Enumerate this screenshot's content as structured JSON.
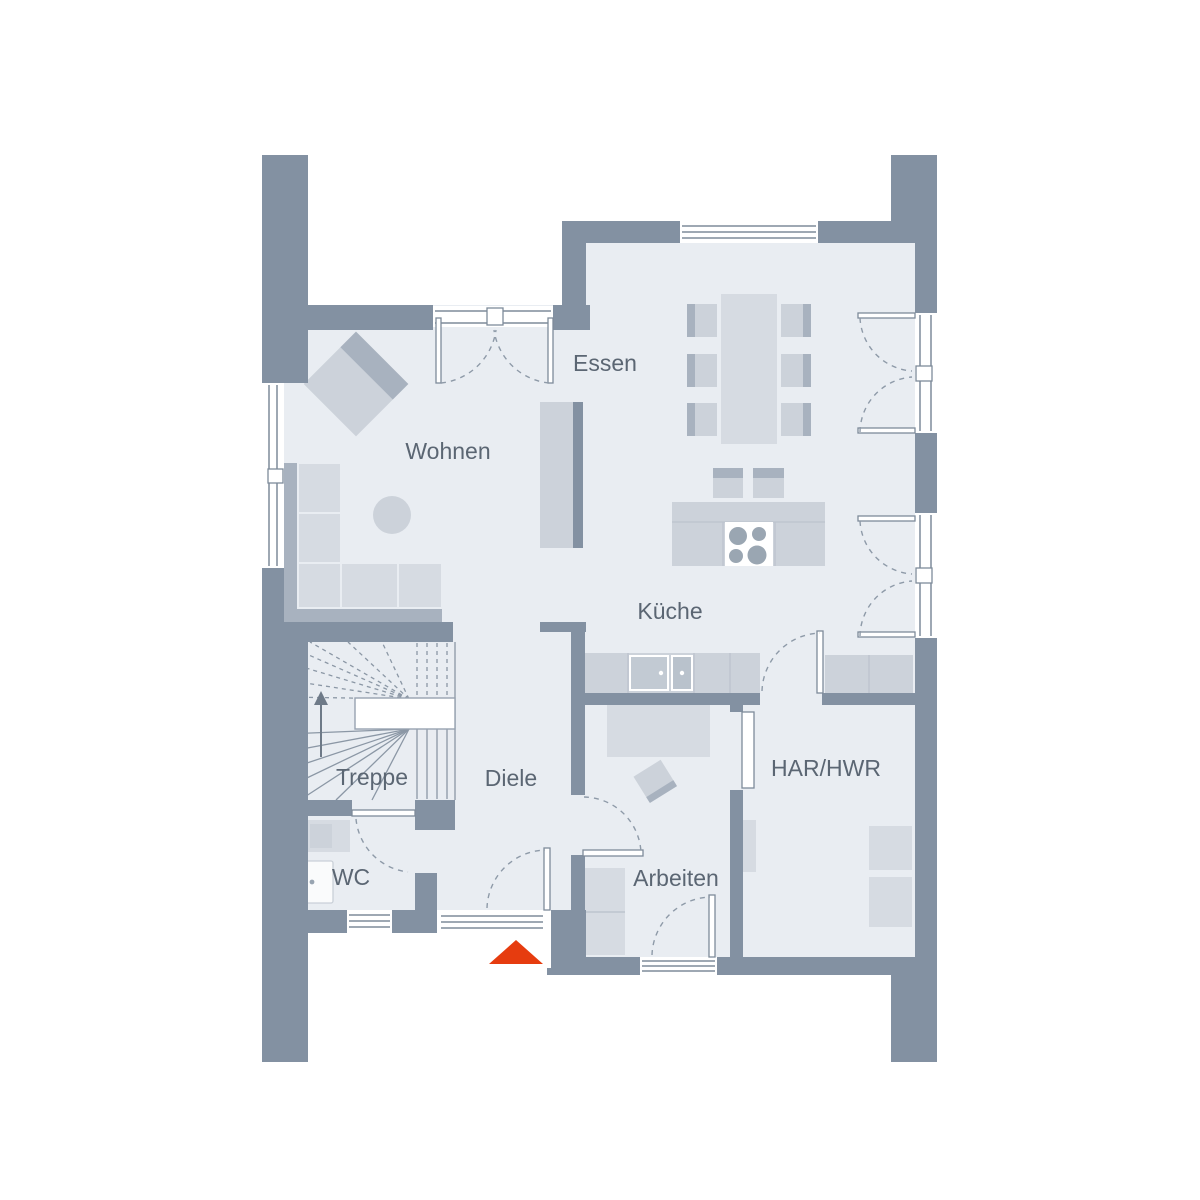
{
  "plan": {
    "rooms": [
      {
        "id": "wohnen",
        "label": "Wohnen"
      },
      {
        "id": "essen",
        "label": "Essen"
      },
      {
        "id": "kueche",
        "label": "Küche"
      },
      {
        "id": "treppe",
        "label": "Treppe"
      },
      {
        "id": "diele",
        "label": "Diele"
      },
      {
        "id": "wc",
        "label": "WC"
      },
      {
        "id": "arbeiten",
        "label": "Arbeiten"
      },
      {
        "id": "har_hwr",
        "label": "HAR/HWR"
      }
    ],
    "colors": {
      "wall": "#8391a2",
      "floor": "#e9edf2",
      "furniture_light": "#d6dbe2",
      "furniture_mid": "#ccd2da",
      "furniture_dark": "#a8b2bf",
      "line": "#8e9aa8",
      "text": "#5b6673",
      "entrance_marker": "#e63c0f"
    }
  }
}
